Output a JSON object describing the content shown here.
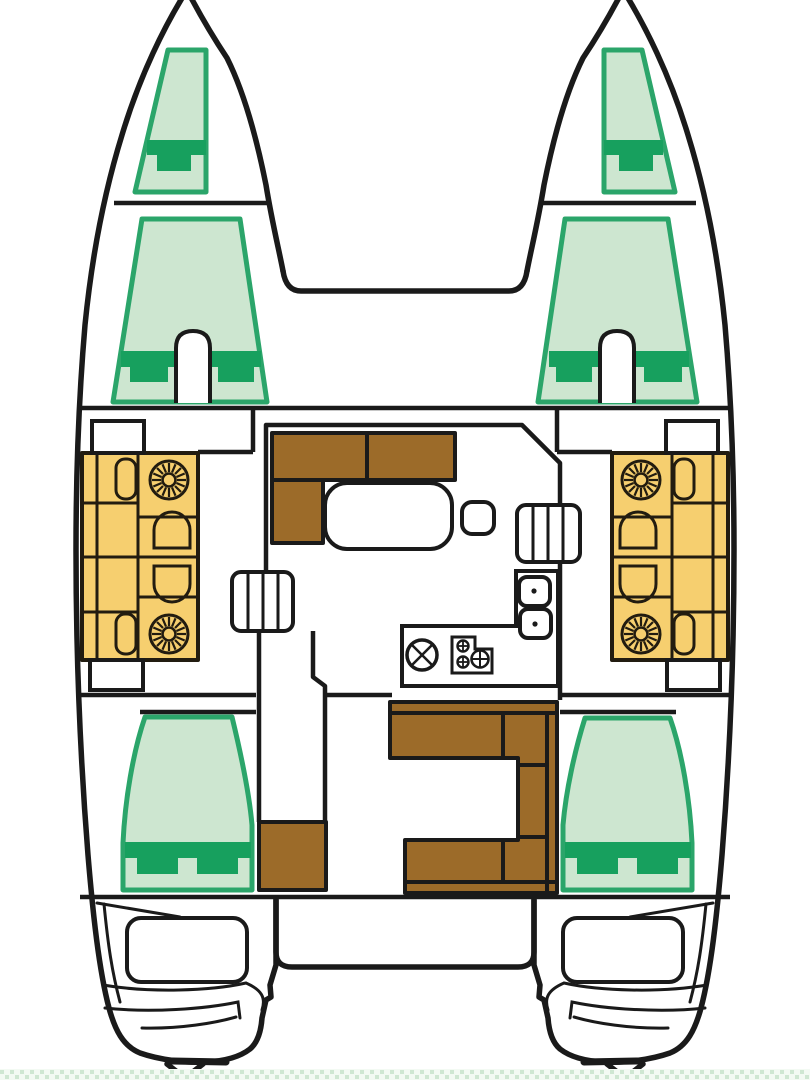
{
  "diagram": {
    "description": "Top-down floor plan of a 4-cabin catamaran interior",
    "text_labels": [],
    "areas": [
      {
        "id": "forepeak-berth-port",
        "kind": "crew-berth"
      },
      {
        "id": "forepeak-berth-starboard",
        "kind": "crew-berth"
      },
      {
        "id": "forward-cabin-port",
        "kind": "double-berth"
      },
      {
        "id": "forward-cabin-starboard",
        "kind": "double-berth"
      },
      {
        "id": "saloon",
        "kind": "sofa-table-dinette"
      },
      {
        "id": "galley",
        "kind": "sinks-stove-counter"
      },
      {
        "id": "cockpit-bench-port",
        "kind": "seating-with-tables"
      },
      {
        "id": "cockpit-bench-starboard",
        "kind": "seating-with-tables"
      },
      {
        "id": "aft-settee",
        "kind": "c-shaped-seat"
      },
      {
        "id": "aft-cabin-port",
        "kind": "double-berth"
      },
      {
        "id": "aft-cabin-starboard",
        "kind": "double-berth"
      },
      {
        "id": "transom-port",
        "kind": "engine-hatch-steps"
      },
      {
        "id": "transom-starboard",
        "kind": "engine-hatch-steps"
      }
    ],
    "icons": [
      "sunburst-table-icon",
      "arch-seat-icon",
      "sink-icon",
      "stove-burner-icon",
      "hatch-cross-icon",
      "steps-icon",
      "rudder-icon"
    ]
  },
  "colors": {
    "background": "#ffffff",
    "outline": "#1a1a1a",
    "berth_fill": "#cde6d0",
    "berth_border": "#2ba56a",
    "berth_pillow": "#17a05e",
    "seating_fill": "#f6cf6f",
    "furniture_outline": "#221c10",
    "wood_fill": "#9c6b29",
    "water_strip_bg": "#f3faf3",
    "water_strip_dot": "#cfe7d2"
  }
}
